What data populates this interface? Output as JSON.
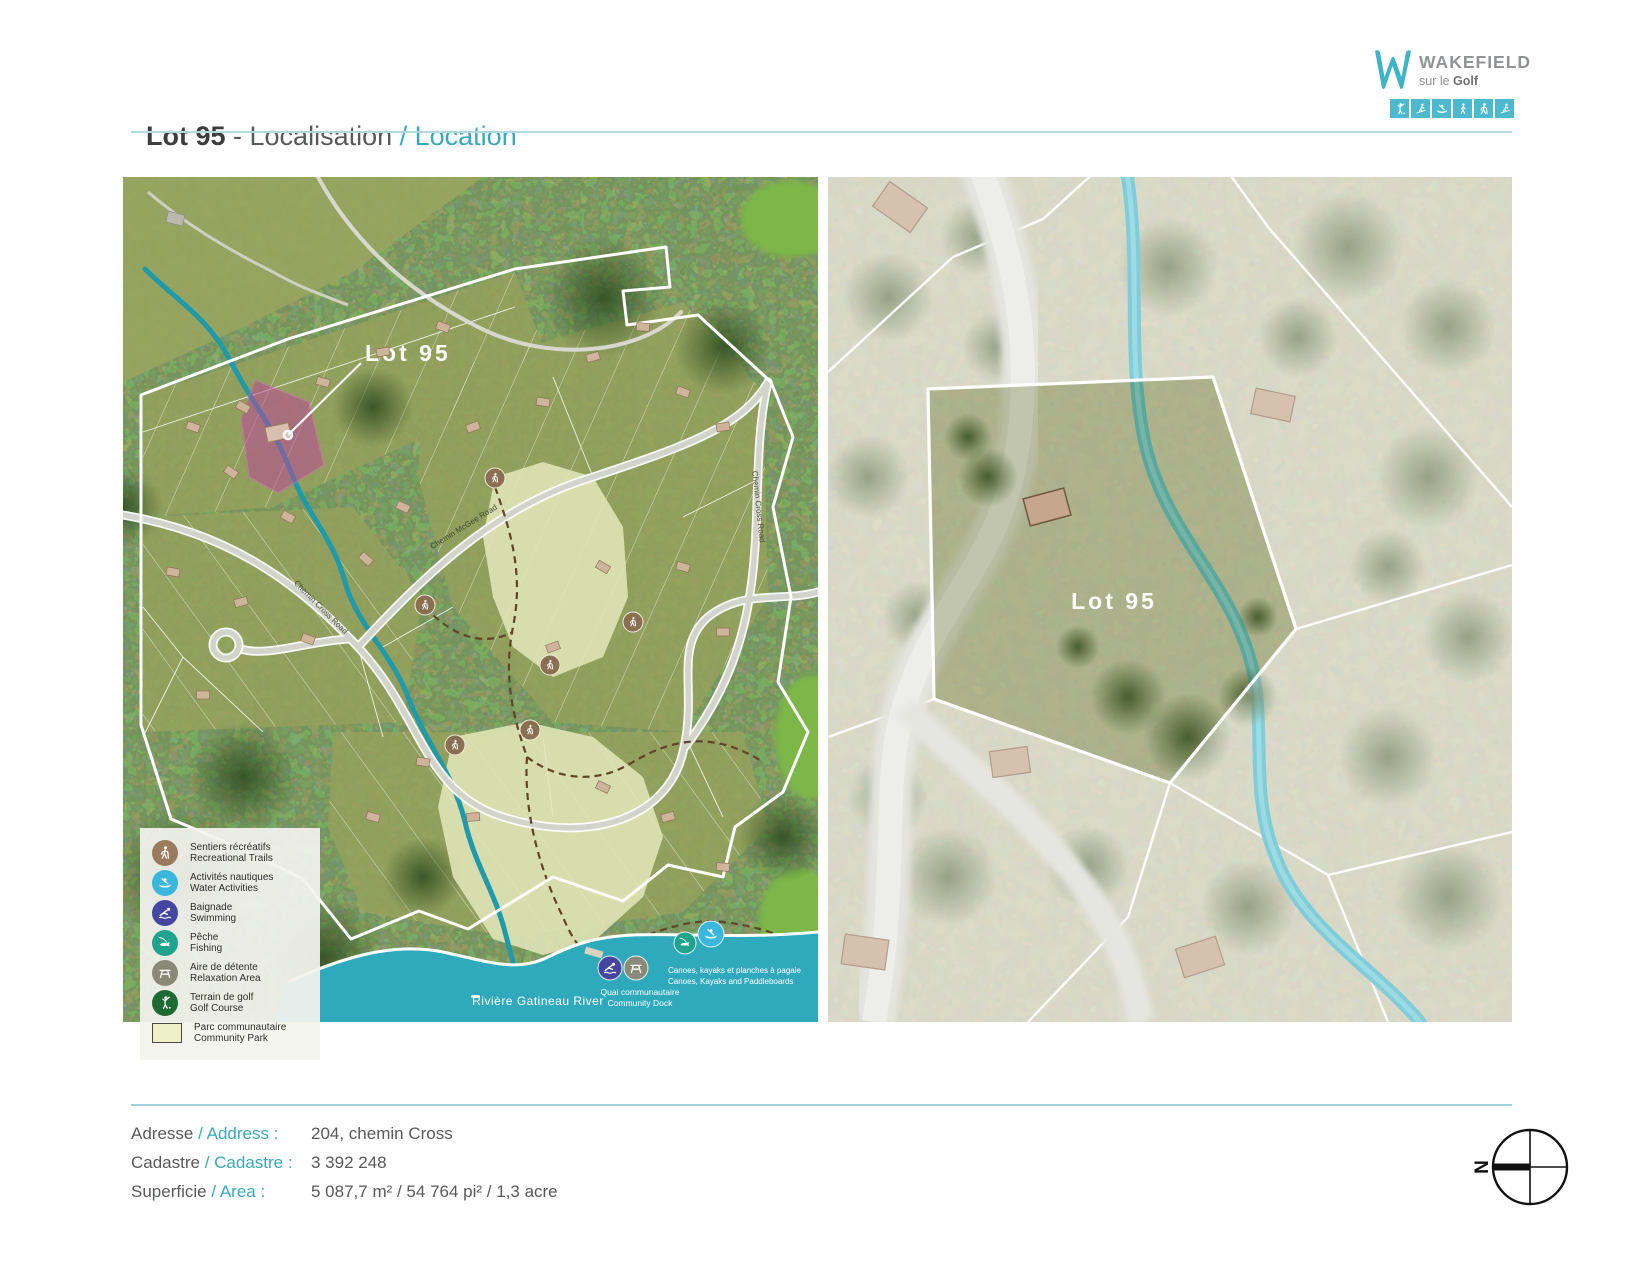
{
  "header": {
    "title_lot": "Lot 95",
    "title_fr": " - Localisation ",
    "title_en": "/ Location"
  },
  "logo": {
    "brand": "WAKEFIELD",
    "tagline_prefix": "sur le ",
    "tagline_bold": "Golf",
    "activity_icons": [
      "golf",
      "ski",
      "canoe",
      "walk",
      "hike",
      "xc-ski"
    ]
  },
  "left_map": {
    "lot_label": "Lot 95",
    "road_label_1": "Chemin Cross Road",
    "road_label_2": "Chemin Cross Road",
    "road_label_3": "Chemin McGee Road",
    "river_label": "Rivière Gatineau River",
    "dock_label_fr": "Quai communautaire",
    "dock_label_en": "Community Dock",
    "watersports_label_fr": "Canoes, kayaks et planches à pagaie",
    "watersports_label_en": "Canoes, Kayaks and Paddleboards",
    "legend": {
      "items": [
        {
          "fr": "Sentiers récréatifs",
          "en": "Recreational Trails"
        },
        {
          "fr": "Activités nautiques",
          "en": "Water Activities"
        },
        {
          "fr": "Baignade",
          "en": "Swimming"
        },
        {
          "fr": "Pêche",
          "en": "Fishing"
        },
        {
          "fr": "Aire de détente",
          "en": "Relaxation Area"
        },
        {
          "fr": "Terrain de golf",
          "en": "Golf Course"
        },
        {
          "fr": "Parc communautaire",
          "en": "Community Park"
        }
      ]
    }
  },
  "right_map": {
    "lot_label": "Lot 95"
  },
  "details": {
    "rows": [
      {
        "fr": "Adresse ",
        "en": "/ Address :",
        "value": "204, chemin Cross"
      },
      {
        "fr": "Cadastre ",
        "en": "/ Cadastre :",
        "value": "3 392 248"
      },
      {
        "fr": "Superficie ",
        "en": "/ Area :",
        "value": "5 087,7 m² / 54 764 pi² / 1,3 acre"
      }
    ]
  },
  "compass": {
    "north": "N"
  },
  "colors": {
    "accent_teal": "#39a9bb",
    "legend_trails": "#9b7b5e",
    "legend_water": "#3bb7dd",
    "legend_swim": "#4446a0",
    "legend_fishing": "#1fa38d",
    "legend_relax": "#8a8a78",
    "legend_golf": "#1d6b33",
    "legend_park": "#eef0c8",
    "lot_highlight": "#c2489e",
    "river": "#2fa9bc",
    "logo_teal": "#3eb4c9"
  }
}
